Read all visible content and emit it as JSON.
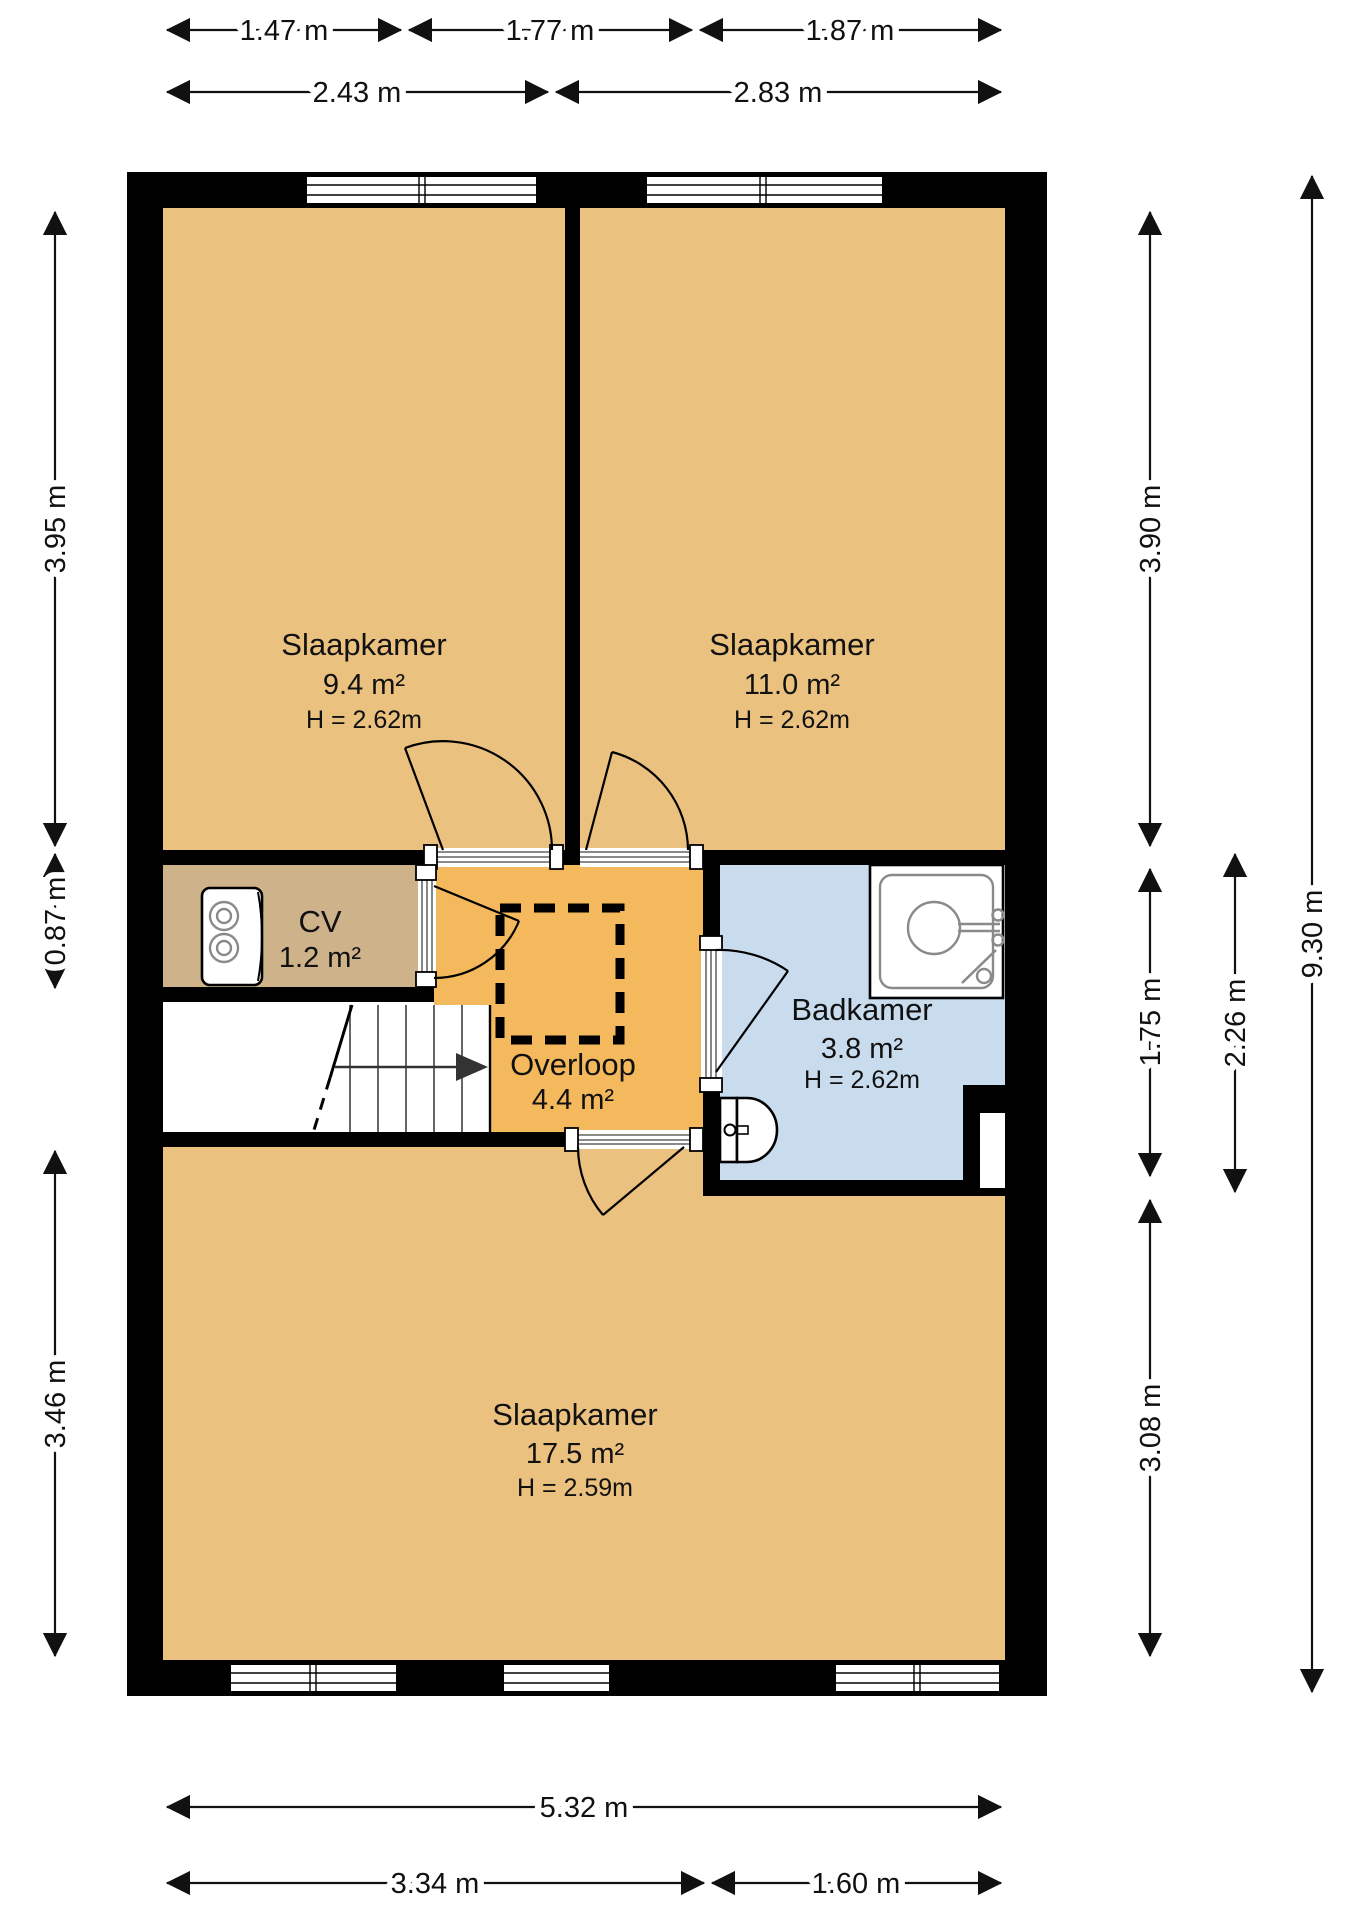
{
  "plan_title": "floor-plan-upper-storey",
  "rooms": {
    "slaapkamer_tl": {
      "name": "Slaapkamer",
      "area": "9.4 m²",
      "ceiling": "H = 2.62m",
      "color": "#EAC17F"
    },
    "slaapkamer_tr": {
      "name": "Slaapkamer",
      "area": "11.0 m²",
      "ceiling": "H = 2.62m",
      "color": "#EAC17F"
    },
    "cv": {
      "name": "CV",
      "area": "1.2 m²",
      "color": "#CDB28A"
    },
    "overloop": {
      "name": "Overloop",
      "area": "4.4 m²",
      "color": "#F5B95D"
    },
    "badkamer": {
      "name": "Badkamer",
      "area": "3.8 m²",
      "ceiling": "H = 2.62m",
      "color": "#C9DCEE"
    },
    "slaapkamer_bottom": {
      "name": "Slaapkamer",
      "area": "17.5 m²",
      "ceiling": "H = 2.59m",
      "color": "#EAC17F"
    }
  },
  "dimensions": {
    "top_row1": [
      "1.47 m",
      "1.77 m",
      "1.87 m"
    ],
    "top_row2": [
      "2.43 m",
      "2.83 m"
    ],
    "left": [
      "3.95 m",
      "0.87 m",
      "3.46 m"
    ],
    "right_inner": [
      "3.90 m",
      "1.75 m",
      "3.08 m"
    ],
    "right_mid": "2.26 m",
    "right_outer": "9.30 m",
    "bottom_total": "5.32 m",
    "bottom_split": [
      "3.34 m",
      "1.60 m"
    ]
  },
  "colors": {
    "wall": "#000000",
    "bedroom_fill": "#EAC17F",
    "cv_fill": "#CDB28A",
    "overloop_fill": "#F5B95D",
    "bathroom_fill": "#C9DCEE",
    "background": "#FFFFFF"
  }
}
